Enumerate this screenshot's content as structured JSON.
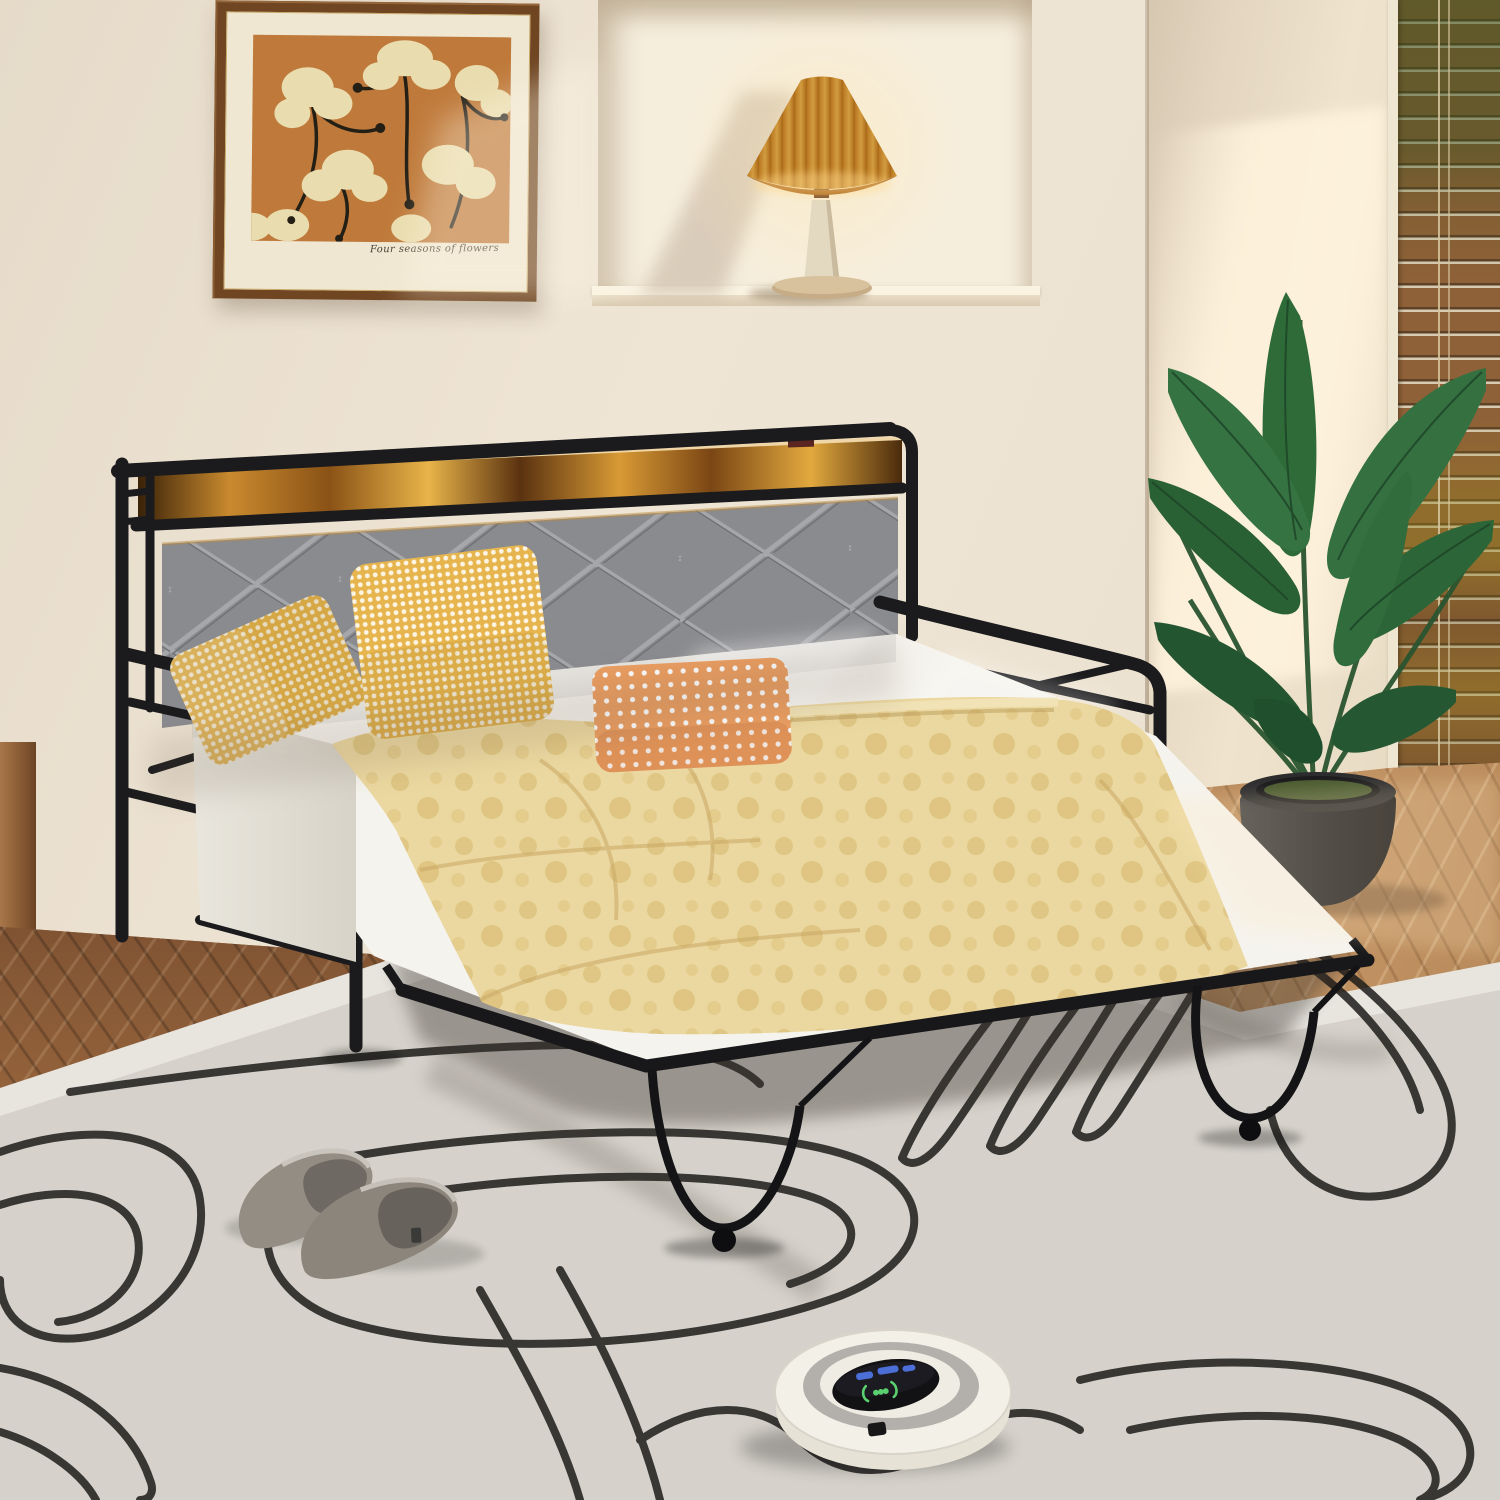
{
  "scene": {
    "description": "Bedroom product photo: black metal daybed with pull-out trundle, upholstered headboard with LED wood shelf, yellow bedding, wall art, pleated lamp in niche, wooden blinds, potted plant, grey slippers, robot vacuum on abstract line-art rug",
    "artwork_caption": "Four seasons of flowers"
  },
  "objects": {
    "wall_art": "framed botanical print",
    "table_lamp": "pleated cone table lamp",
    "window_blinds": "wooden venetian blinds",
    "plant": "potted banana-leaf plant",
    "daybed": "black metal daybed frame",
    "headboard": "grey diamond-tufted headboard with LED wood shelf",
    "pillows": [
      "yellow gingham pillow",
      "yellow gingham pillow",
      "orange polka-dot pillow"
    ],
    "duvet": "pale yellow floral-dot duvet",
    "trundle": "pull-out trundle frame with caster wheels",
    "slippers": "grey house slippers",
    "robot_vacuum": "white robot vacuum cleaner",
    "rug": "light grey rug with black abstract line art",
    "floor": "herringbone wood floor"
  },
  "palette": {
    "wall": "#ece2d2",
    "niche": "#f6eedd",
    "led_wood": "#c98a2e",
    "frame_black": "#1c1c1e",
    "headboard_grey": "#8a8b8f",
    "duvet_yellow": "#ebd8a0",
    "pillow_yellow": "#e6b54e",
    "pillow_orange": "#eb9e61",
    "rug_grey": "#d6d2cb",
    "leaf_green": "#2f6d3a",
    "lamp_amber": "#e2a23a",
    "vacuum_green": "#5ad06e",
    "vacuum_blue": "#4b6fd6"
  }
}
